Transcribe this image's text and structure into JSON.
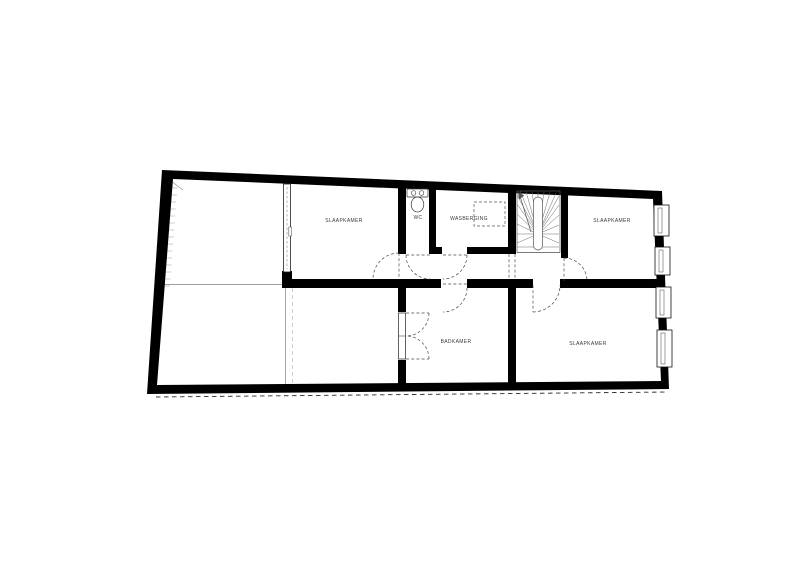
{
  "floorplan": {
    "kind": "residential-floor-plan",
    "rooms": [
      {
        "id": "slaapkamer-top-left",
        "label": "SLAAPKAMER"
      },
      {
        "id": "wc",
        "label": "WC"
      },
      {
        "id": "wasberging",
        "label": "WASBERGING"
      },
      {
        "id": "slaapkamer-top-right",
        "label": "SLAAPKAMER"
      },
      {
        "id": "badkamer",
        "label": "BADKAMER"
      },
      {
        "id": "slaapkamer-bottom-right",
        "label": "SLAAPKAMER"
      }
    ],
    "colors": {
      "wall": "#000000",
      "thin_line": "#9e9e9e",
      "door_line": "#4a4a4a",
      "label_text": "#3a3a3a",
      "background": "#ffffff"
    }
  }
}
